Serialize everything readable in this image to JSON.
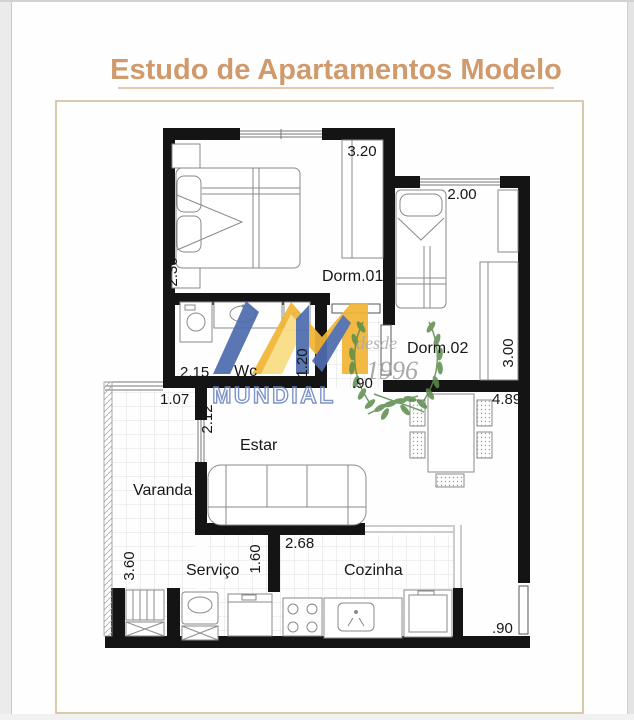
{
  "title": "Estudo de Apartamentos Modelo",
  "rooms": {
    "dorm1": "Dorm.01",
    "dorm2": "Dorm.02",
    "wc": "Wc",
    "estar": "Estar",
    "varanda": "Varanda",
    "servico": "Serviço",
    "cozinha": "Cozinha"
  },
  "dimensions": {
    "dorm1_width": "3.20",
    "dorm1_depth": "2.36",
    "dorm2_width": "2.00",
    "dorm2_depth": "3.00",
    "wc_width": "2.15",
    "wc_depth": "1.20",
    "hall_width": ".90",
    "varanda_opening": "1.07",
    "estar_depth": "2.12",
    "living_width": "4.89",
    "varanda_depth": "3.60",
    "servico_depth": "1.60",
    "cozinha_width": "2.68",
    "service_door_width": ".90"
  },
  "watermarks": {
    "brand": "MUNDIAL",
    "since_word": "desde",
    "since_year": "1996"
  },
  "colors": {
    "title": "#d09a6c",
    "frame": "#cdb891",
    "wall": "#141414",
    "logo_blue": "#4e6cae",
    "logo_yellow": "#f2b535",
    "logo_yellow_light": "#f9dc83",
    "logo_text": "#6d86c3",
    "wreath_green": "#5c8c4c"
  }
}
